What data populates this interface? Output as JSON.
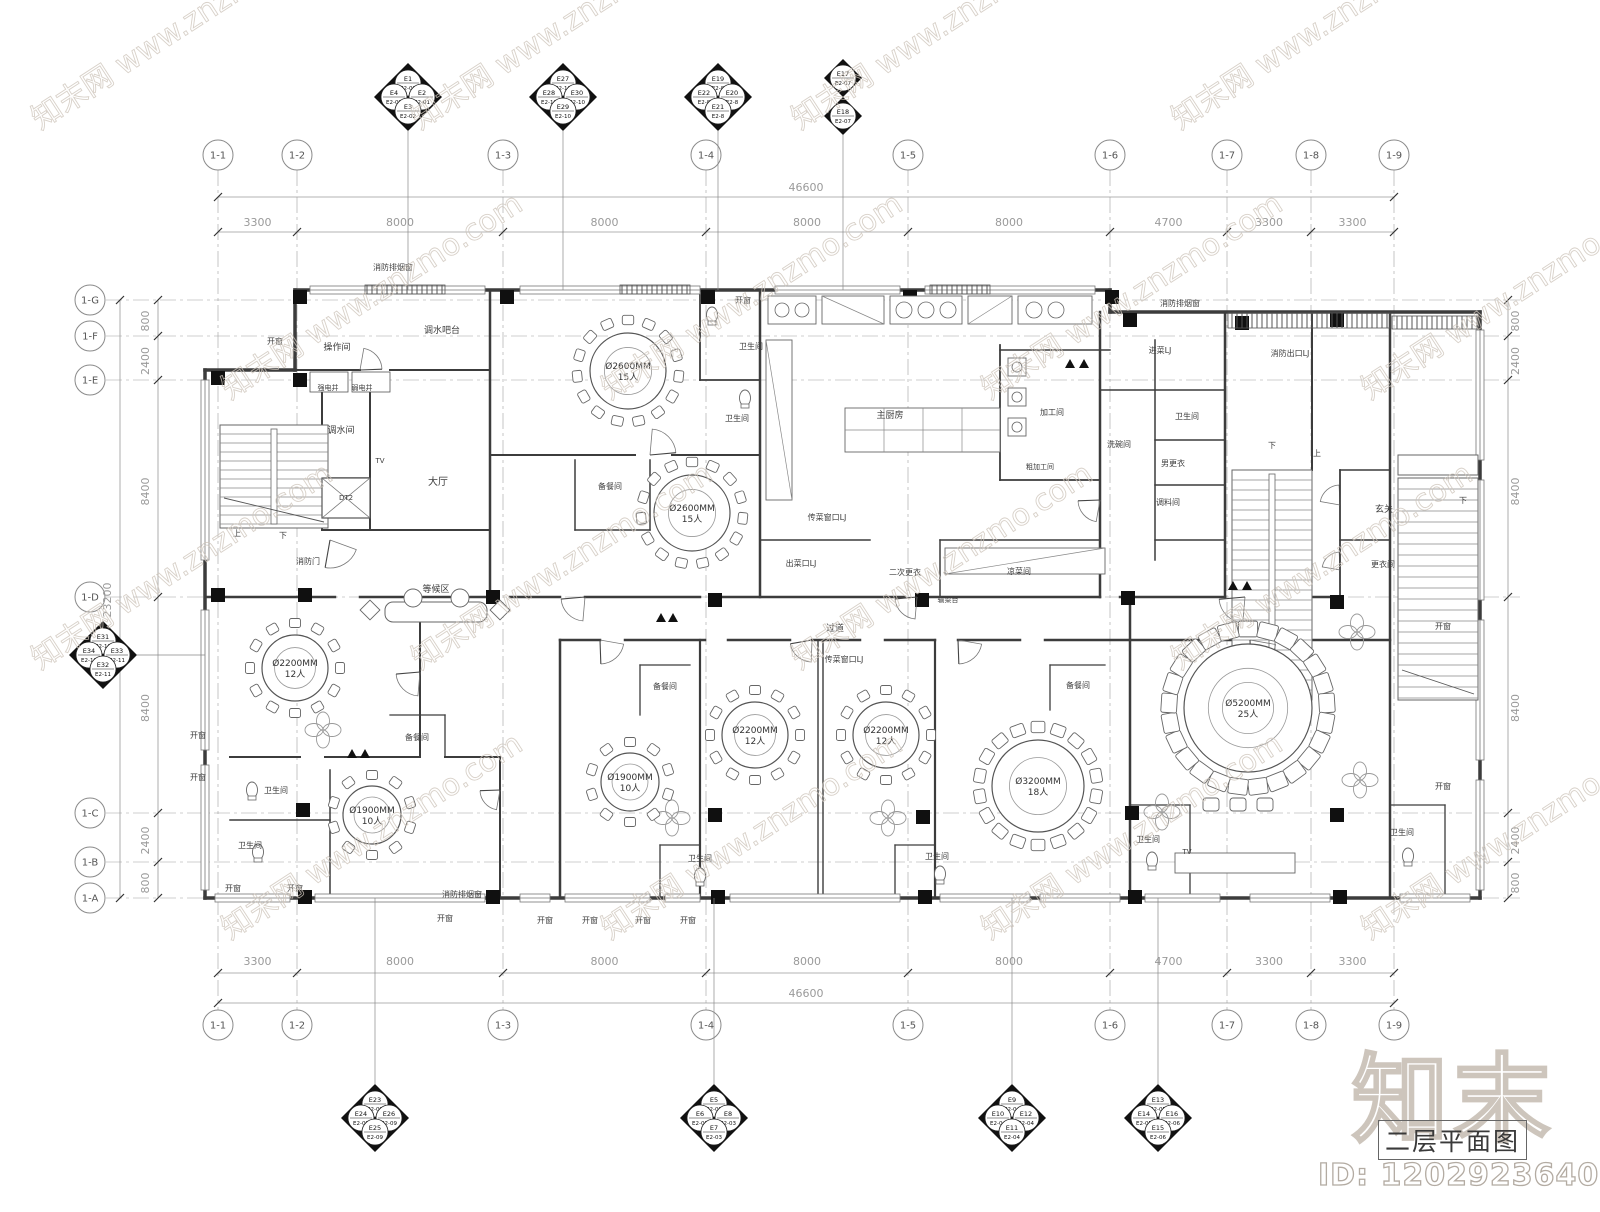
{
  "title_block": {
    "drawing_title": "二层平面图",
    "watermark_id": "ID: 1202923640",
    "logo_text": "知末"
  },
  "watermark": {
    "tile_text": "知末网 www.znzmo.com",
    "color": "#cfc6bc"
  },
  "colors": {
    "wall": "#3c3c3c",
    "thin_line": "#6f6f6f",
    "grid_line": "#9f9f9f",
    "dim_text": "#9a9a9a",
    "label_text": "#3d3d3d",
    "column_fill": "#101010"
  },
  "grid": {
    "total_width_label": "46600",
    "total_height_label": "23200",
    "cols": [
      {
        "label": "1-1",
        "x": 218
      },
      {
        "label": "1-2",
        "x": 297
      },
      {
        "label": "1-3",
        "x": 503
      },
      {
        "label": "1-4",
        "x": 706
      },
      {
        "label": "1-5",
        "x": 908
      },
      {
        "label": "1-6",
        "x": 1110
      },
      {
        "label": "1-7",
        "x": 1227
      },
      {
        "label": "1-8",
        "x": 1311
      },
      {
        "label": "1-9",
        "x": 1394
      }
    ],
    "col_segments": [
      "3300",
      "8000",
      "8000",
      "8000",
      "8000",
      "4700",
      "3300",
      "3300"
    ],
    "rows": [
      {
        "label": "1-G",
        "y": 300
      },
      {
        "label": "1-F",
        "y": 336
      },
      {
        "label": "1-E",
        "y": 380
      },
      {
        "label": "1-D",
        "y": 597
      },
      {
        "label": "1-C",
        "y": 813
      },
      {
        "label": "1-B",
        "y": 862
      },
      {
        "label": "1-A",
        "y": 898
      }
    ],
    "row_segments": [
      "800",
      "2400",
      "8400",
      "8400",
      "2400",
      "800"
    ]
  },
  "electrical_markers": {
    "top": [
      {
        "x": 408,
        "y": 97,
        "n": [
          "E1",
          "E2-01"
        ],
        "w": [
          "E4",
          "E2-02"
        ],
        "e": [
          "E2",
          "E2-01"
        ],
        "s": [
          "E3",
          "E2-02"
        ]
      },
      {
        "x": 563,
        "y": 97,
        "n": [
          "E27",
          "E2-10"
        ],
        "w": [
          "E28",
          "E2-10"
        ],
        "e": [
          "E30",
          "E2-10"
        ],
        "s": [
          "E29",
          "E2-10"
        ]
      },
      {
        "x": 718,
        "y": 97,
        "n": [
          "E19",
          "E2-8"
        ],
        "w": [
          "E22",
          "E2-8"
        ],
        "e": [
          "E20",
          "E2-8"
        ],
        "s": [
          "E21",
          "E2-8"
        ]
      }
    ],
    "top_pair": [
      {
        "x": 843,
        "y": 78,
        "c": [
          "E17",
          "E2-07"
        ]
      },
      {
        "x": 843,
        "y": 116,
        "c": [
          "E18",
          "E2-07"
        ]
      }
    ],
    "left": [
      {
        "x": 103,
        "y": 655,
        "n": [
          "E31",
          "E2-11"
        ],
        "w": [
          "E34",
          "E2-11"
        ],
        "e": [
          "E33",
          "E2-11"
        ],
        "s": [
          "E32",
          "E2-11"
        ]
      }
    ],
    "bottom": [
      {
        "x": 375,
        "y": 1118,
        "n": [
          "E23",
          "E2-09"
        ],
        "w": [
          "E24",
          "E2-09"
        ],
        "e": [
          "E26",
          "E2-09"
        ],
        "s": [
          "E25",
          "E2-09"
        ]
      },
      {
        "x": 714,
        "y": 1118,
        "n": [
          "E5",
          "E2-03"
        ],
        "w": [
          "E6",
          "E2-03"
        ],
        "e": [
          "E8",
          "E2-03"
        ],
        "s": [
          "E7",
          "E2-03"
        ]
      },
      {
        "x": 1012,
        "y": 1118,
        "n": [
          "E9",
          "E2-04"
        ],
        "w": [
          "E10",
          "E2-04"
        ],
        "e": [
          "E12",
          "E2-04"
        ],
        "s": [
          "E11",
          "E2-04"
        ]
      },
      {
        "x": 1158,
        "y": 1118,
        "n": [
          "E13",
          "E2-05"
        ],
        "w": [
          "E14",
          "E2-05"
        ],
        "e": [
          "E16",
          "E2-06"
        ],
        "s": [
          "E15",
          "E2-06"
        ]
      }
    ]
  },
  "tables": [
    {
      "x": 628,
      "y": 371,
      "r": 38,
      "ring": 51,
      "n": 15,
      "l1": "Ø2600MM",
      "l2": "15人"
    },
    {
      "x": 692,
      "y": 513,
      "r": 38,
      "ring": 51,
      "n": 15,
      "l1": "Ø2600MM",
      "l2": "15人"
    },
    {
      "x": 295,
      "y": 668,
      "r": 33,
      "ring": 45,
      "n": 12,
      "l1": "Ø2200MM",
      "l2": "12人"
    },
    {
      "x": 372,
      "y": 815,
      "r": 29,
      "ring": 40,
      "n": 10,
      "l1": "Ø1900MM",
      "l2": "10人"
    },
    {
      "x": 630,
      "y": 782,
      "r": 29,
      "ring": 40,
      "n": 10,
      "l1": "Ø1900MM",
      "l2": "10人"
    },
    {
      "x": 755,
      "y": 735,
      "r": 33,
      "ring": 45,
      "n": 12,
      "l1": "Ø2200MM",
      "l2": "12人"
    },
    {
      "x": 886,
      "y": 735,
      "r": 33,
      "ring": 45,
      "n": 12,
      "l1": "Ø2200MM",
      "l2": "12人"
    },
    {
      "x": 1038,
      "y": 786,
      "r": 46,
      "ring": 59,
      "n": 18,
      "l1": "Ø3200MM",
      "l2": "18人"
    },
    {
      "x": 1248,
      "y": 708,
      "r": 64,
      "ring": 79,
      "n": 25,
      "l1": "Ø5200MM",
      "l2": "25人"
    }
  ],
  "room_labels": [
    {
      "t": "消防排烟窗",
      "x": 393,
      "y": 270,
      "s": 8
    },
    {
      "t": "开窗",
      "x": 275,
      "y": 344,
      "s": 8
    },
    {
      "t": "开窗",
      "x": 743,
      "y": 303,
      "s": 8
    },
    {
      "t": "操作间",
      "x": 337,
      "y": 350,
      "s": 9
    },
    {
      "t": "调水吧台",
      "x": 442,
      "y": 333,
      "s": 9
    },
    {
      "t": "强电井",
      "x": 328,
      "y": 390,
      "s": 7
    },
    {
      "t": "弱电井",
      "x": 362,
      "y": 390,
      "s": 7
    },
    {
      "t": "调水间",
      "x": 341,
      "y": 433,
      "s": 9
    },
    {
      "t": "DT2",
      "x": 346,
      "y": 500,
      "s": 7
    },
    {
      "t": "大厅",
      "x": 438,
      "y": 485,
      "s": 10
    },
    {
      "t": "消防门",
      "x": 308,
      "y": 564,
      "s": 8
    },
    {
      "t": "等候区",
      "x": 436,
      "y": 592,
      "s": 9
    },
    {
      "t": "卫生间",
      "x": 751,
      "y": 349,
      "s": 8
    },
    {
      "t": "卫生间",
      "x": 737,
      "y": 421,
      "s": 8
    },
    {
      "t": "备餐间",
      "x": 610,
      "y": 489,
      "s": 8
    },
    {
      "t": "主厨房",
      "x": 890,
      "y": 418,
      "s": 9
    },
    {
      "t": "加工间",
      "x": 1052,
      "y": 415,
      "s": 8
    },
    {
      "t": "粗加工间",
      "x": 1040,
      "y": 469,
      "s": 7
    },
    {
      "t": "洗碗间",
      "x": 1119,
      "y": 447,
      "s": 8
    },
    {
      "t": "卫生间",
      "x": 1187,
      "y": 419,
      "s": 8
    },
    {
      "t": "男更衣",
      "x": 1173,
      "y": 466,
      "s": 8
    },
    {
      "t": "调料间",
      "x": 1168,
      "y": 505,
      "s": 8
    },
    {
      "t": "凉菜间",
      "x": 1019,
      "y": 574,
      "s": 8
    },
    {
      "t": "二次更衣",
      "x": 905,
      "y": 575,
      "s": 8
    },
    {
      "t": "出菜口LJ",
      "x": 801,
      "y": 566,
      "s": 8
    },
    {
      "t": "传菜窗口LJ",
      "x": 827,
      "y": 520,
      "s": 8
    },
    {
      "t": "输菜台",
      "x": 948,
      "y": 602,
      "s": 7
    },
    {
      "t": "进菜LJ",
      "x": 1160,
      "y": 353,
      "s": 8
    },
    {
      "t": "消防出口LJ",
      "x": 1290,
      "y": 356,
      "s": 8
    },
    {
      "t": "消防排烟窗",
      "x": 1180,
      "y": 306,
      "s": 8
    },
    {
      "t": "消防排烟窗",
      "x": 462,
      "y": 897,
      "s": 8
    },
    {
      "t": "玄关",
      "x": 1384,
      "y": 512,
      "s": 9
    },
    {
      "t": "更衣间",
      "x": 1383,
      "y": 567,
      "s": 8
    },
    {
      "t": "卫生间",
      "x": 700,
      "y": 861,
      "s": 8
    },
    {
      "t": "卫生间",
      "x": 937,
      "y": 859,
      "s": 8
    },
    {
      "t": "卫生间",
      "x": 1148,
      "y": 842,
      "s": 8
    },
    {
      "t": "卫生间",
      "x": 1402,
      "y": 835,
      "s": 8
    },
    {
      "t": "卫生间",
      "x": 276,
      "y": 793,
      "s": 8
    },
    {
      "t": "卫生间",
      "x": 250,
      "y": 848,
      "s": 8
    },
    {
      "t": "备餐间",
      "x": 417,
      "y": 740,
      "s": 8
    },
    {
      "t": "备餐间",
      "x": 665,
      "y": 689,
      "s": 8
    },
    {
      "t": "备餐间",
      "x": 1078,
      "y": 688,
      "s": 8
    },
    {
      "t": "过道",
      "x": 835,
      "y": 631,
      "s": 9
    },
    {
      "t": "传菜窗口LJ",
      "x": 844,
      "y": 662,
      "s": 8
    },
    {
      "t": "开窗",
      "x": 198,
      "y": 738,
      "s": 8
    },
    {
      "t": "开窗",
      "x": 198,
      "y": 780,
      "s": 8
    },
    {
      "t": "开窗",
      "x": 233,
      "y": 891,
      "s": 8
    },
    {
      "t": "开窗",
      "x": 295,
      "y": 891,
      "s": 8
    },
    {
      "t": "开窗",
      "x": 445,
      "y": 921,
      "s": 8
    },
    {
      "t": "开窗",
      "x": 545,
      "y": 923,
      "s": 8
    },
    {
      "t": "开窗",
      "x": 590,
      "y": 923,
      "s": 8
    },
    {
      "t": "开窗",
      "x": 643,
      "y": 923,
      "s": 8
    },
    {
      "t": "开窗",
      "x": 688,
      "y": 923,
      "s": 8
    },
    {
      "t": "开窗",
      "x": 1443,
      "y": 629,
      "s": 8
    },
    {
      "t": "开窗",
      "x": 1443,
      "y": 789,
      "s": 8
    },
    {
      "t": "上",
      "x": 237,
      "y": 536,
      "s": 8
    },
    {
      "t": "下",
      "x": 283,
      "y": 538,
      "s": 8
    },
    {
      "t": "下",
      "x": 1272,
      "y": 448,
      "s": 8
    },
    {
      "t": "上",
      "x": 1317,
      "y": 456,
      "s": 8
    },
    {
      "t": "下",
      "x": 1463,
      "y": 503,
      "s": 8
    },
    {
      "t": "TV",
      "x": 1187,
      "y": 854,
      "s": 7
    },
    {
      "t": "TV",
      "x": 380,
      "y": 463,
      "s": 7
    }
  ]
}
